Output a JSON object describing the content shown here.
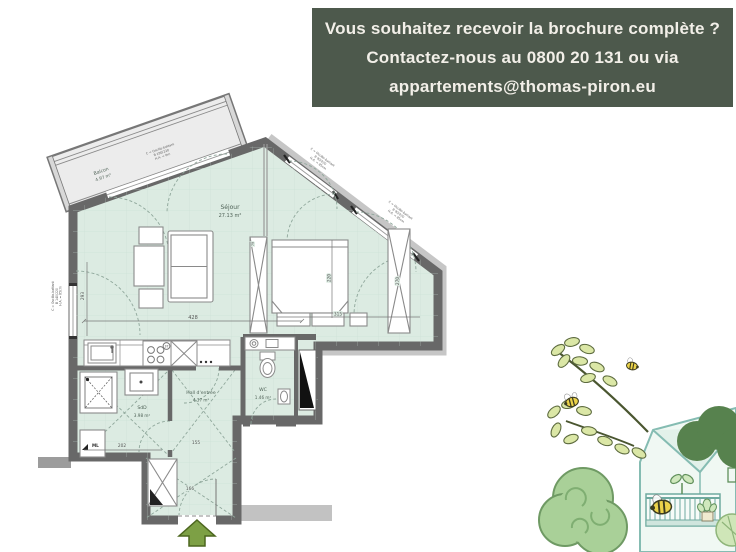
{
  "banner": {
    "line1": "Vous souhaitez recevoir la brochure complète ?",
    "line2": "Contactez-nous au 0800 20 131 ou via",
    "line3": "appartements@thomas-piron.eu",
    "bg_color": "#4d594c",
    "text_color": "#f2efe8"
  },
  "floorplan": {
    "rooms": {
      "sejour": {
        "name": "Séjour",
        "area": "27.13 m²"
      },
      "hall": {
        "name": "Hall d'entrée",
        "area": "4.37 m²"
      },
      "wc": {
        "name": "WC",
        "area": "1.46 m²"
      },
      "sdd": {
        "name": "SdD",
        "area": "3.98 m²"
      },
      "balcon": {
        "name": "Balcon",
        "area": "4.97 m²"
      }
    },
    "dimensions": {
      "living_width": "428",
      "left_wall": "293",
      "bed_length": "220",
      "bed_zone_width": "315",
      "wardrobe_right": "270",
      "sdd_width": "202",
      "hall_width": "155",
      "entry_width": "166",
      "partition": "79",
      "hob": "37"
    },
    "labels": {
      "washing_machine": "ML"
    },
    "window_annotations": {
      "balcony_door": [
        "C = Oscillo-battant",
        "B 190/220",
        "H.A. = 0m"
      ],
      "window_right_1": [
        "C = Oscillo-battant",
        "B 90/220",
        "H.A. = 85cm"
      ],
      "window_right_2": [
        "C = Oscillo-battant",
        "B 90/220",
        "H.A. = 85cm"
      ],
      "window_left": [
        "C = Oscillo-battant",
        "B 140/220",
        "H.A. = 85cm"
      ]
    },
    "colors": {
      "floor": "#dcebe2",
      "wall": "#686868",
      "balcony_floor": "#ececec",
      "entrance_arrow": "#7da045"
    }
  }
}
